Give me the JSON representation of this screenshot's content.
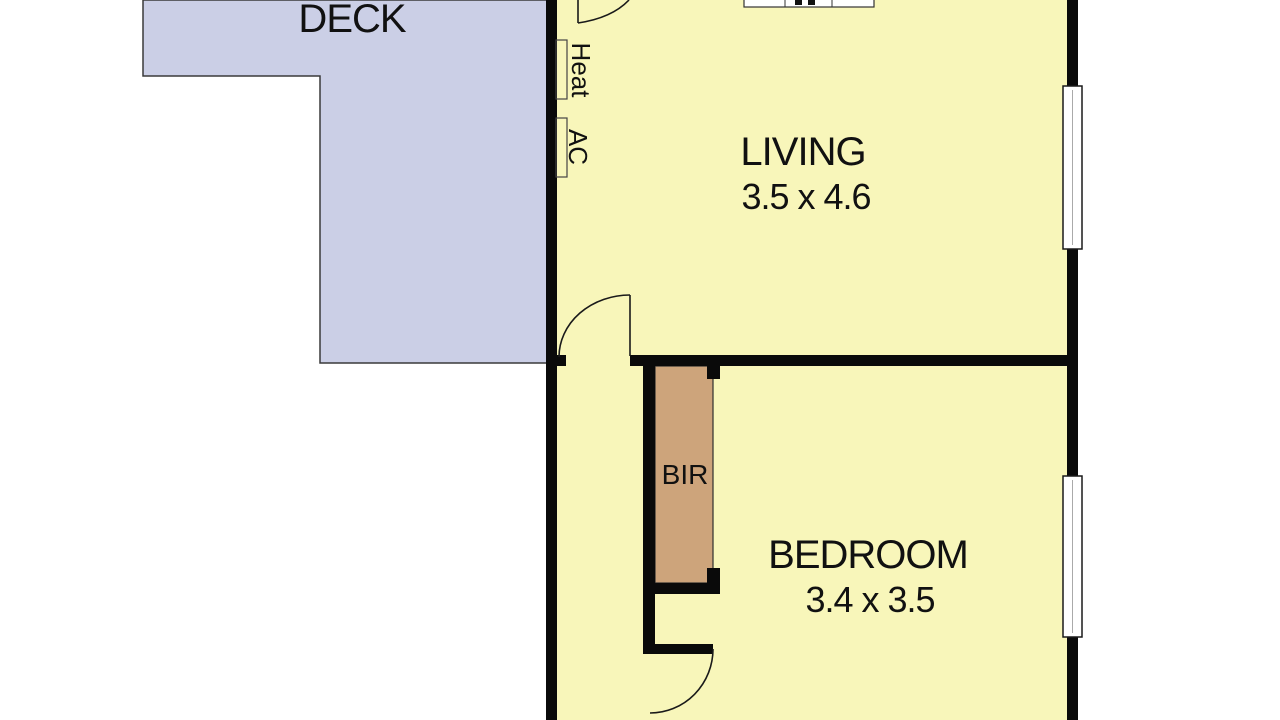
{
  "rooms": {
    "deck": {
      "name": "DECK"
    },
    "living": {
      "name": "LIVING",
      "dimensions": "3.5 x 4.6"
    },
    "bedroom": {
      "name": "BEDROOM",
      "dimensions": "3.4 x 3.5"
    },
    "robe": {
      "name": "BIR"
    }
  },
  "fixtures": {
    "heater_label": "Heat",
    "air_conditioner_label": "AC"
  },
  "colors": {
    "background": "#ffffff",
    "room_fill": "#f8f6ba",
    "deck_fill": "#cbcfe6",
    "robe_fill": "#cda47b",
    "wall": "#0a0a0a",
    "window_fill": "#ffffff",
    "outline": "#2f2f2f",
    "text": "#111111"
  }
}
